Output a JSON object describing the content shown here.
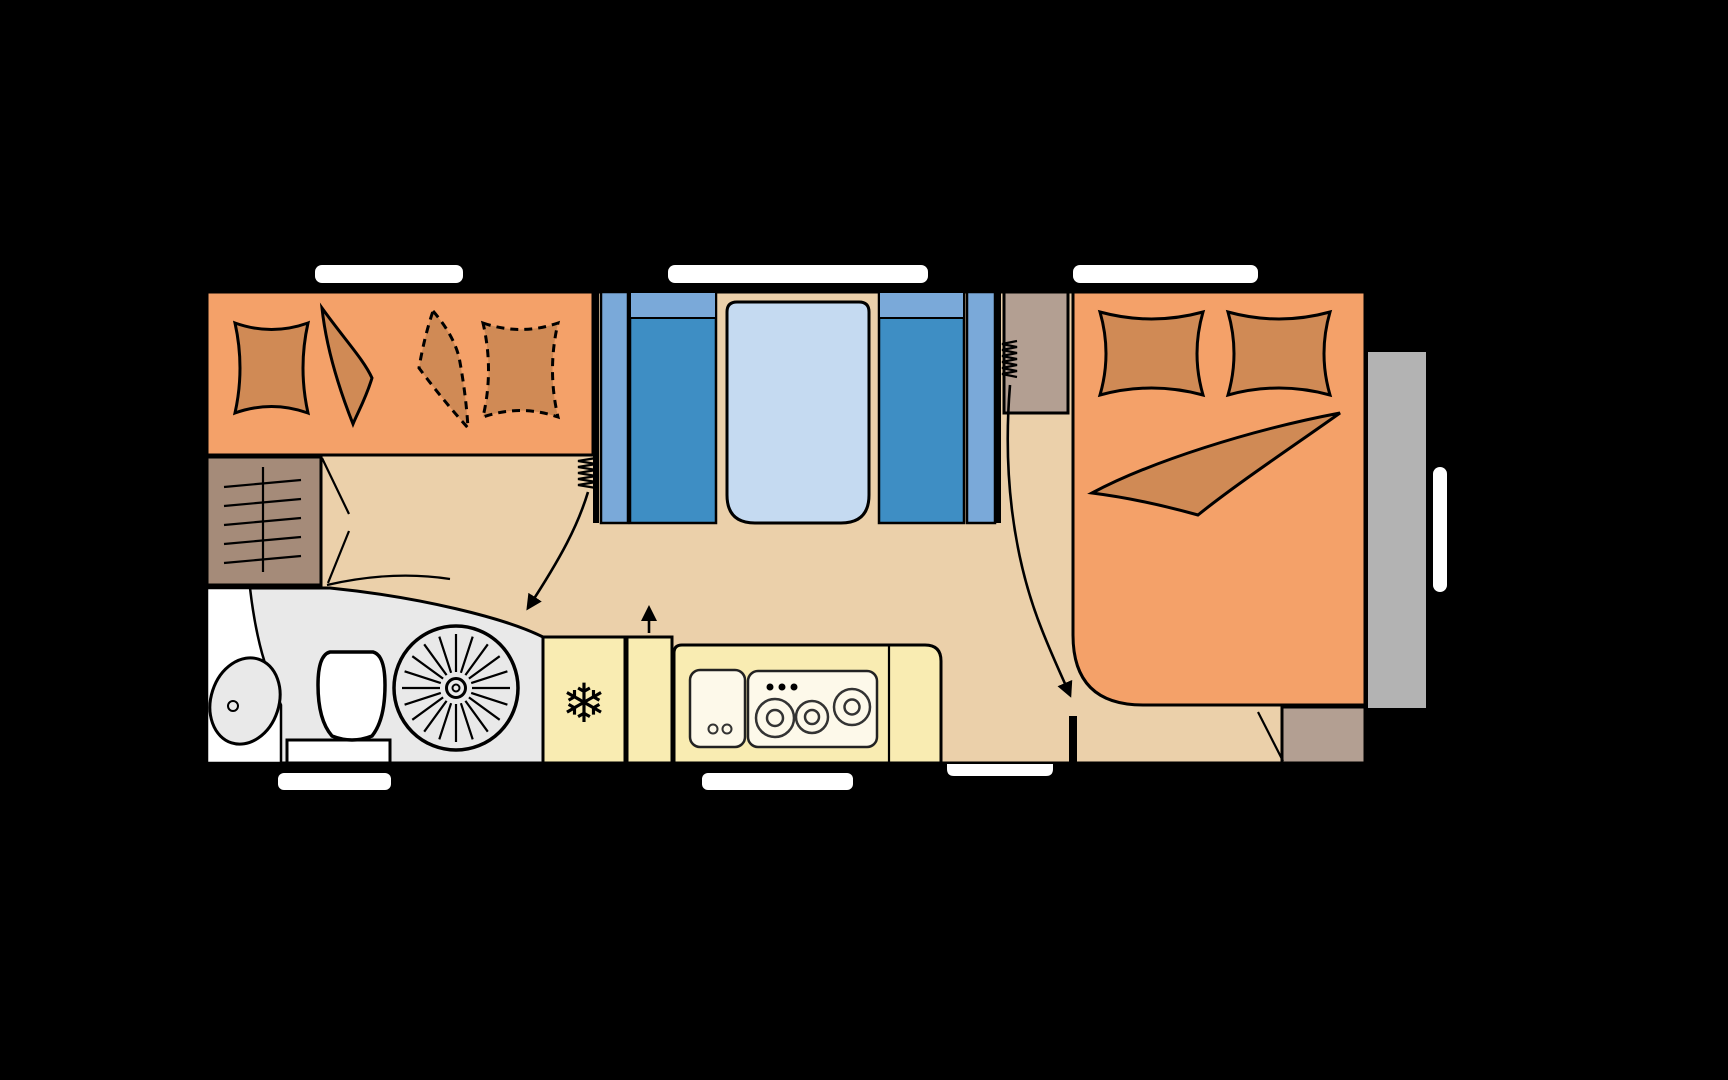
{
  "canvas": {
    "width": 1728,
    "height": 1080,
    "background": "#000000"
  },
  "floorplan": {
    "type": "caravan-floor-plan",
    "colors": {
      "upholstery_orange": "#f4a169",
      "cushion_brown": "#d08a55",
      "floor_tan": "#ebd0aa",
      "seat_blue": "#3e8ec4",
      "seat_back_blue": "#7aa9d9",
      "table_blue": "#c5daf1",
      "wardrobe_brown": "#a58b79",
      "cabinet_brown": "#b39f92",
      "bathroom_gray": "#e9e9e9",
      "kitchen_yellow": "#f9ecb2",
      "appliance_cream": "#fdf9ea",
      "exterior_gray": "#b3b3b3",
      "opening_white": "#ffffff",
      "outline_black": "#000000"
    },
    "icons": {
      "fridge_snowflake": "❄"
    },
    "counts": {
      "top_windows": 3,
      "bottom_openings": 3,
      "bed_pillows": 2,
      "bunk_pillows_solid": 1,
      "bunk_pillows_dashed": 1,
      "hob_burners": 3,
      "heater_springs": 2,
      "arrows": 3
    }
  }
}
